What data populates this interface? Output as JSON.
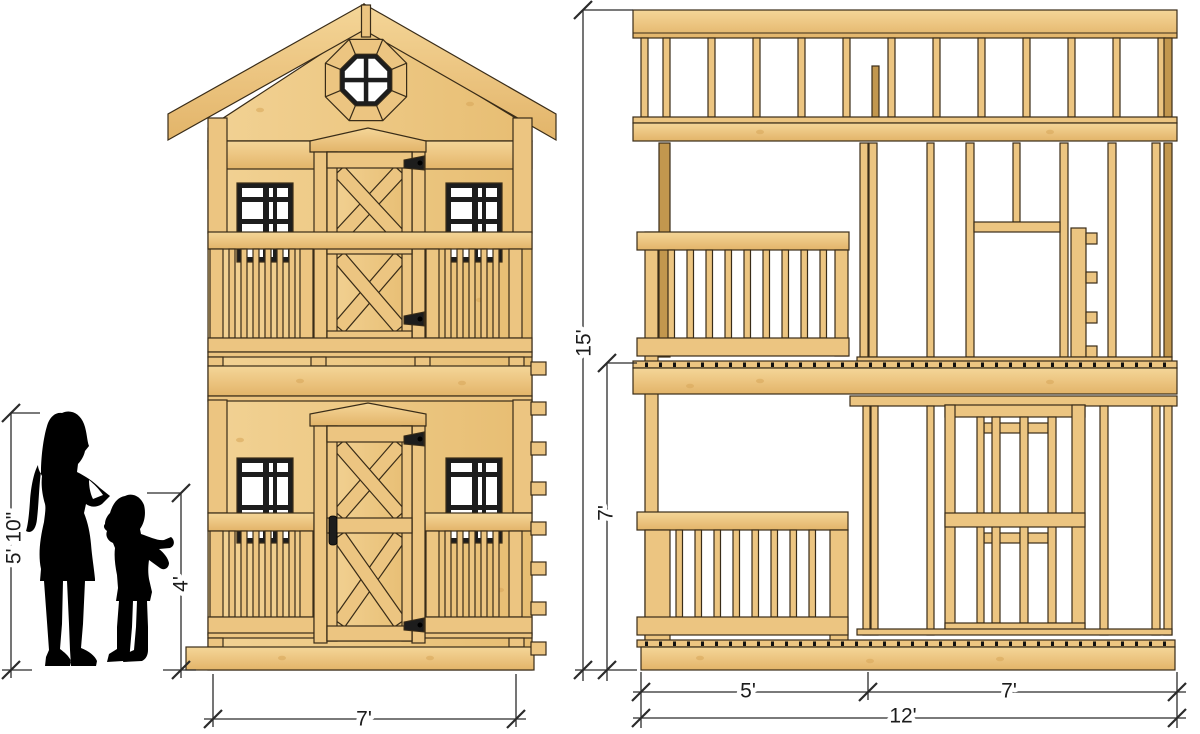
{
  "drawing": {
    "front_view": {
      "adult_height_label": "5' 10\"",
      "child_height_label": "4'",
      "width_label": "7'"
    },
    "side_view": {
      "total_height_label": "15'",
      "lower_story_height_label": "7'",
      "porch_depth_label": "5'",
      "interior_depth_label": "7'",
      "total_depth_label": "12'"
    }
  },
  "colors": {
    "wood": "#ecc581",
    "wood_light": "#f5d99f",
    "wood_shade": "#c2974e",
    "wood_dark": "#a87f3e",
    "outline": "#392c18",
    "window_frame": "#1d1d1d",
    "glass": "#ffffff",
    "dimension": "#2b2b2b",
    "silhouette": "#000000",
    "background": "#ffffff"
  }
}
